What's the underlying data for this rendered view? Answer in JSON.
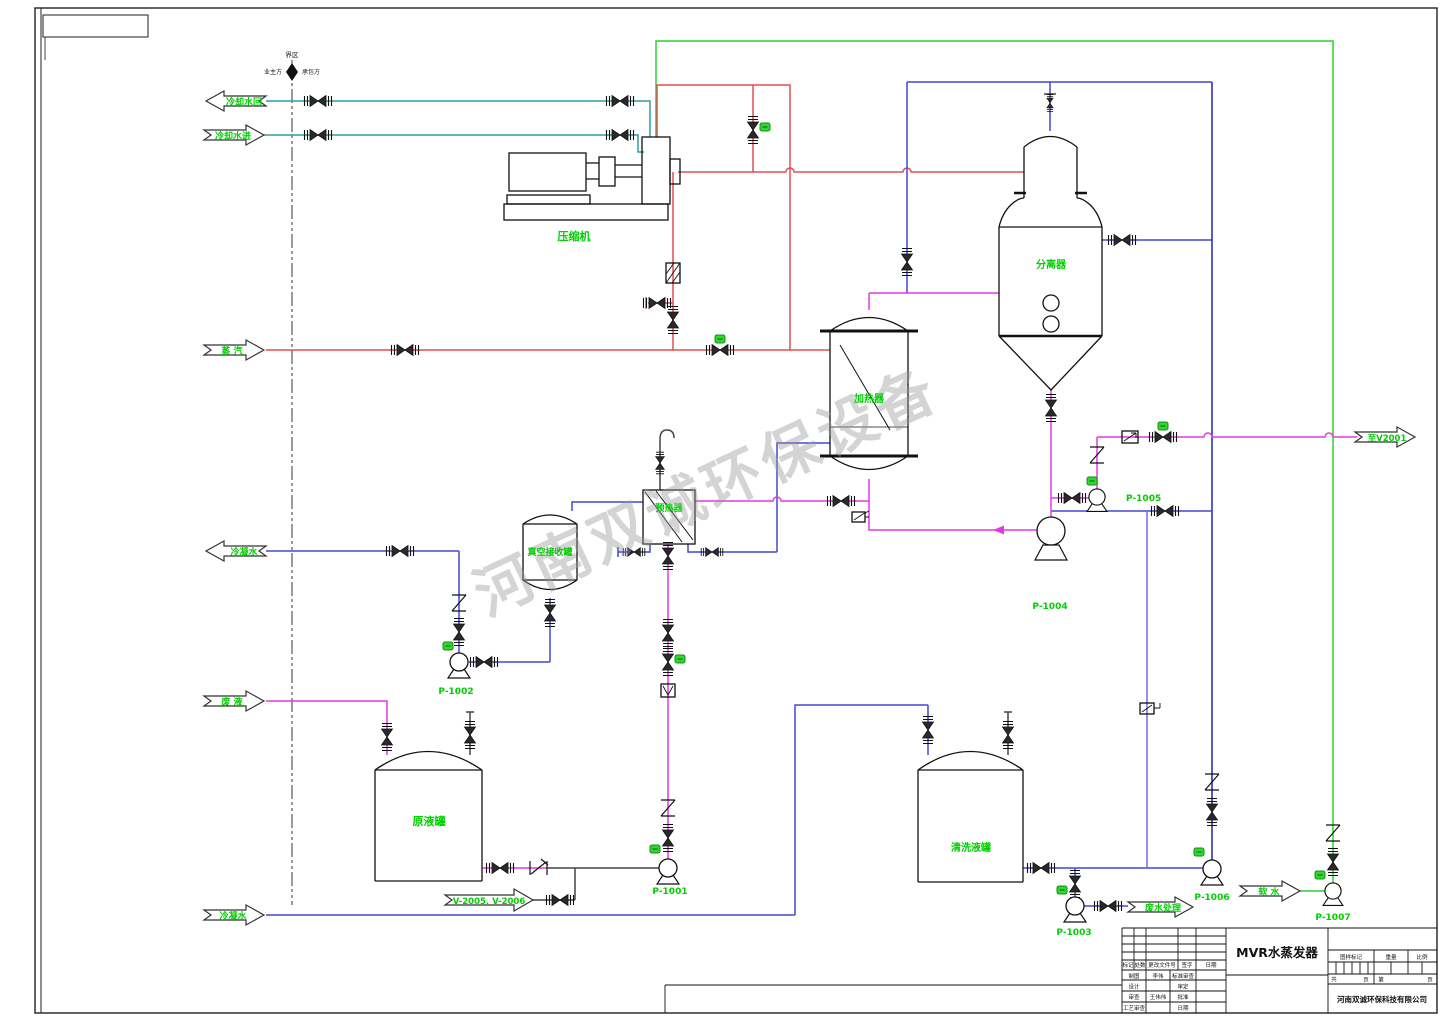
{
  "watermark": {
    "text": "河南双诚环保设备"
  },
  "boundary": {
    "top": "界区",
    "left": "业主方",
    "right": "承包方"
  },
  "streams": {
    "cooling_return": "冷却水回",
    "cooling_supply": "冷却水进",
    "steam": "蒸 汽",
    "condensate_out": "冷凝水",
    "waste_liquid": "废 液",
    "condensate_in": "冷凝水",
    "tags_v2005": "V-2005, V-2006",
    "to_v2001": "至V2001",
    "soft_water": "软 水",
    "wastewater": "废水处理"
  },
  "equipment": {
    "compressor": "压缩机",
    "separator": "分离器",
    "heater": "加热器",
    "vacuum_receiver": "真空接收罐",
    "preheater": "预热器",
    "raw_tank": "原液罐",
    "cleaning_tank": "清洗液罐"
  },
  "pumps": {
    "p1001": "P-1001",
    "p1002": "P-1002",
    "p1003": "P-1003",
    "p1004": "P-1004",
    "p1005": "P-1005",
    "p1006": "P-1006",
    "p1007": "P-1007"
  },
  "title_block": {
    "drawing_title": "MVR水蒸发器",
    "company": "河南双诚环保科技有限公司",
    "rev": {
      "mark": "标记",
      "qty": "处数",
      "doc": "更改文件号",
      "sign": "签字",
      "date": "日期"
    },
    "roles": {
      "draft": "制图",
      "draft_name": "李伟",
      "std_check": "标准审查",
      "design": "设计",
      "approve": "审定",
      "check": "审查",
      "check_name": "王伟伟",
      "ratify": "批准",
      "process_check": "工艺审查",
      "date": "日期"
    },
    "right": {
      "stamp": "图样标记",
      "weight": "重量",
      "scale": "比例",
      "total": "共",
      "sheet": "页",
      "no": "第",
      "sheet2": "页"
    }
  },
  "colors": {
    "label_green": "#00cf00",
    "pipe_teal": "#2f9e9e",
    "pipe_green": "#2bd32b",
    "pipe_red": "#e05050",
    "pipe_blue": "#4646d2",
    "pipe_navy": "#2525a8",
    "pipe_violet": "#7a6ae0",
    "pipe_magenta": "#e23ae2"
  }
}
